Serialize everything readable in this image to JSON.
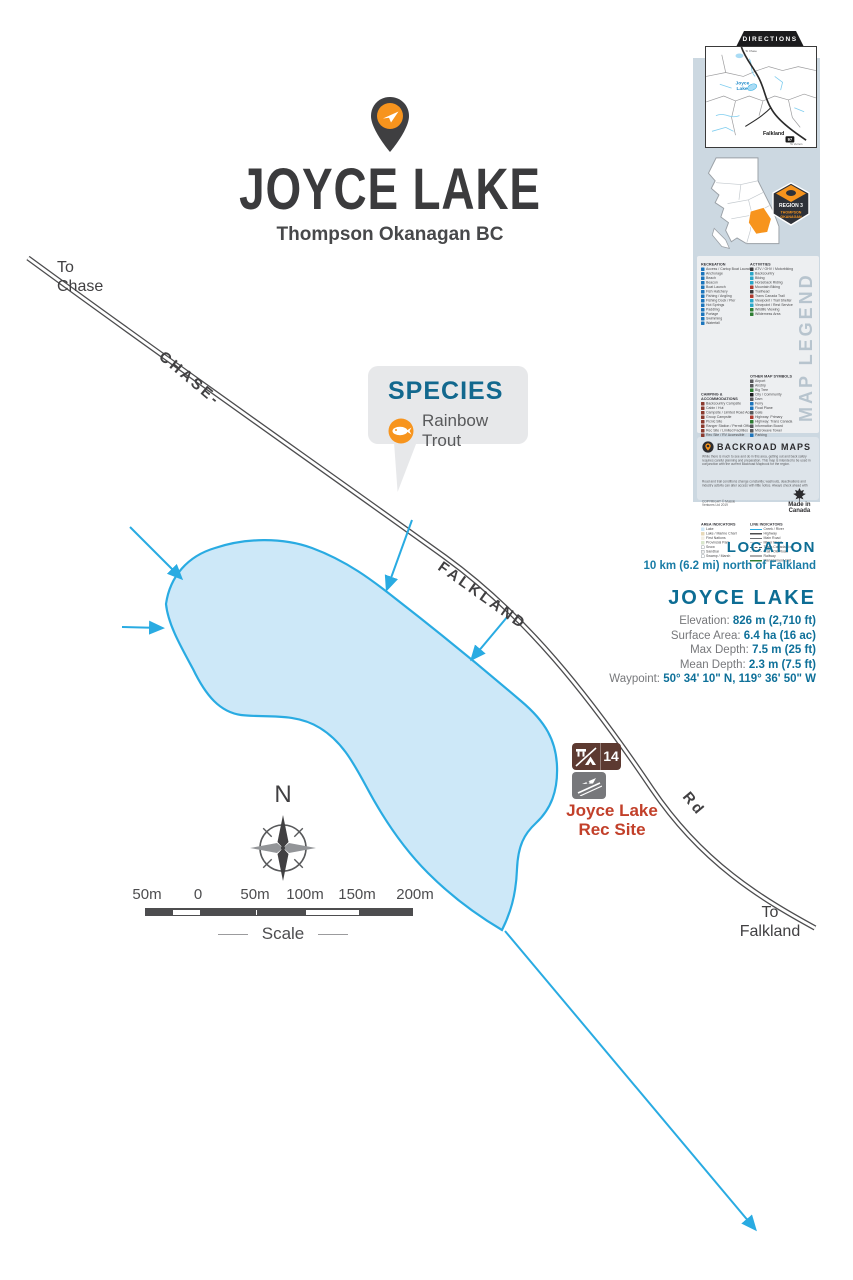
{
  "title": {
    "name": "JOYCE LAKE",
    "subtitle": "Thompson Okanagan BC"
  },
  "species": {
    "heading": "SPECIES",
    "items": [
      "Rainbow Trout"
    ]
  },
  "map": {
    "destinations": {
      "north": "To\nChase",
      "south": "To\nFalkland"
    },
    "road_labels": {
      "seg1": "CHASE-",
      "seg2": "FALKLAND",
      "seg3": "Rd"
    },
    "rec_site": {
      "label_line1": "Joyce Lake",
      "label_line2": "Rec Site",
      "campsite_number": "14"
    },
    "compass": {
      "north": "N"
    },
    "scale": {
      "labels": [
        "50m",
        "0",
        "50m",
        "100m",
        "150m",
        "200m"
      ],
      "caption": "Scale"
    }
  },
  "info": {
    "location": {
      "heading": "LOCATION",
      "value": "10 km (6.2 mi) north of Falkland"
    },
    "lake": {
      "heading": "JOYCE LAKE",
      "stats": [
        {
          "label": "Elevation:",
          "value": "826 m (2,710 ft)"
        },
        {
          "label": "Surface Area:",
          "value": "6.4 ha (16 ac)"
        },
        {
          "label": "Max Depth:",
          "value": "7.5 m (25 ft)"
        },
        {
          "label": "Mean Depth:",
          "value": "2.3 m (7.5 ft)"
        },
        {
          "label": "Waypoint:",
          "value": "50° 34' 10\" N, 119° 36' 50\" W"
        }
      ]
    }
  },
  "sidebar": {
    "directions": {
      "tab": "DIRECTIONS",
      "labels": {
        "lake_line1": "Joyce",
        "lake_line2": "Lake",
        "town": "Falkland",
        "shield": "97",
        "dest_top": "To Chase",
        "dest_bottom": "To Vernon"
      }
    },
    "region_badge": {
      "region": "REGION 3",
      "name_line1": "THOMPSON",
      "name_line2": "OKANAGAN"
    },
    "legend": {
      "recreation": {
        "header": "RECREATION",
        "items": [
          {
            "c": "#1c75bc",
            "t": "Access / Cartop Boat Launch"
          },
          {
            "c": "#1c75bc",
            "t": "Anchorage"
          },
          {
            "c": "#1c75bc",
            "t": "Beach"
          },
          {
            "c": "#1c75bc",
            "t": "Beacon"
          },
          {
            "c": "#1c75bc",
            "t": "Boat Launch"
          },
          {
            "c": "#1c75bc",
            "t": "Fish Hatchery"
          },
          {
            "c": "#1c75bc",
            "t": "Fishing / Angling"
          },
          {
            "c": "#1c75bc",
            "t": "Fishing Dock / Pier"
          },
          {
            "c": "#1c75bc",
            "t": "Hot Springs"
          },
          {
            "c": "#1c75bc",
            "t": "Paddling"
          },
          {
            "c": "#1c75bc",
            "t": "Portage"
          },
          {
            "c": "#1c75bc",
            "t": "Swimming"
          },
          {
            "c": "#1c75bc",
            "t": "Waterfall"
          }
        ]
      },
      "camping": {
        "header": "CAMPING & ACCOMMODATIONS",
        "items": [
          {
            "c": "#8b3a2e",
            "t": "Backcountry Campsite"
          },
          {
            "c": "#8b3a2e",
            "t": "Cabin / Hut"
          },
          {
            "c": "#8b3a2e",
            "t": "Campsite / Limited Road Access"
          },
          {
            "c": "#8b3a2e",
            "t": "Group Campsite"
          },
          {
            "c": "#8b3a2e",
            "t": "Picnic Site"
          },
          {
            "c": "#8b3a2e",
            "t": "Ranger Station / Permit Office"
          },
          {
            "c": "#8b3a2e",
            "t": "Rec Site / Limited Facilities"
          },
          {
            "c": "#8b3a2e",
            "t": "Rec Site / RV Accessible"
          },
          {
            "c": "#8b3a2e",
            "t": "Resort / Lodge"
          },
          {
            "c": "#8b3a2e",
            "t": "Tent & Trailer Campground"
          },
          {
            "c": "#8b3a2e",
            "t": "Trails / Full Hookup Campsite"
          }
        ]
      },
      "activities": {
        "header": "ACTIVITIES",
        "items": [
          {
            "c": "#3a3a3c",
            "t": "ATV / OHV / Motorbiking"
          },
          {
            "c": "#2aa7c9",
            "t": "Backcountry"
          },
          {
            "c": "#2aa7c9",
            "t": "Biking"
          },
          {
            "c": "#2aa7c9",
            "t": "Horseback Riding"
          },
          {
            "c": "#b03a2e",
            "t": "Mountain Biking"
          },
          {
            "c": "#3a3a3c",
            "t": "Trailhead"
          },
          {
            "c": "#b03a2e",
            "t": "Trans Canada Trail"
          },
          {
            "c": "#2aa7c9",
            "t": "Viewpoint / Trail Shelter"
          },
          {
            "c": "#2aa7c9",
            "t": "Viewpoint / Rest Service"
          },
          {
            "c": "#2e7d32",
            "t": "Wildlife Viewing"
          },
          {
            "c": "#2e7d32",
            "t": "Wilderness Area"
          }
        ]
      },
      "other": {
        "header": "OTHER MAP SYMBOLS",
        "items": [
          {
            "c": "#58595b",
            "t": "Airport"
          },
          {
            "c": "#58595b",
            "t": "Airstrip"
          },
          {
            "c": "#2e7d32",
            "t": "Big Tree"
          },
          {
            "c": "#1b1b1d",
            "t": "City / Community"
          },
          {
            "c": "#58595b",
            "t": "Dam"
          },
          {
            "c": "#1c75bc",
            "t": "Ferry"
          },
          {
            "c": "#1c75bc",
            "t": "Float Plane"
          },
          {
            "c": "#58595b",
            "t": "Gate"
          },
          {
            "c": "#b03a2e",
            "t": "Highway: Primary"
          },
          {
            "c": "#2e7d32",
            "t": "Highway: Trans Canada"
          },
          {
            "c": "#58595b",
            "t": "Information Board"
          },
          {
            "c": "#58595b",
            "t": "Microwave Tower"
          },
          {
            "c": "#1c75bc",
            "t": "Parking"
          },
          {
            "c": "#f7941d",
            "t": "Point of Interest"
          },
          {
            "c": "#1c75bc",
            "t": "Paddle Station"
          }
        ]
      },
      "area_indicators": {
        "header": "AREA INDICATORS",
        "items": [
          {
            "c": "#cfe8f8",
            "t": "Lake"
          },
          {
            "c": "#e7d9b9",
            "t": "Lake / Marine Chart"
          },
          {
            "c": "#f3efe4",
            "t": "First Nations"
          },
          {
            "c": "#d9e7cd",
            "t": "Provincial Park"
          },
          {
            "c": "#ffffff",
            "t": "Snow"
          },
          {
            "c": "#eeeeee",
            "t": "Sandbar"
          },
          {
            "c": "#ffffff",
            "t": "Swamp / Marsh"
          }
        ]
      },
      "line_indicators": {
        "header": "LINE INDICATORS",
        "items": [
          {
            "s": "river",
            "t": "Creek / River"
          },
          {
            "s": "thick",
            "t": "Highway"
          },
          {
            "s": "solid",
            "t": "Main Road"
          },
          {
            "s": "thin",
            "t": "Minor Road"
          },
          {
            "s": "dashed",
            "t": "Trans Canada Trail"
          },
          {
            "s": "dashes",
            "t": "Trail / Old Road"
          },
          {
            "s": "rail",
            "t": "Railway"
          },
          {
            "s": "green",
            "t": "Management Unit"
          }
        ]
      },
      "watermark": "MAP LEGEND"
    },
    "backroad": {
      "heading": "BACKROAD MAPS",
      "paragraphs": [
        "While there is much to see and do in this area, getting out and back safely requires careful planning and preparation. This map is intended to be used in conjunction with the current Backroad Mapbook for the region.",
        "Road and trail conditions change constantly; washouts, deactivations and industry activity can alter access with little notice. Always check ahead with local authorities before heading out and travel prepared.",
        "The publisher assumes no responsibility for loss or injury incurred while using this map. Enjoy the backroads and please respect private property."
      ],
      "made_in": "Made in Canada",
      "copyright": "COPYRIGHT © Mussio Ventures Ltd 2019"
    }
  },
  "colors": {
    "accent_teal": "#0d6d94",
    "accent_orange": "#f7941d",
    "water_fill": "#cde8f8",
    "water_stroke": "#29abe2",
    "road": "#4d4d4f",
    "rec_site_red": "#c2402a",
    "rec_icon_brown": "#5d3a31",
    "panel_blue": "#ccd8e1"
  }
}
